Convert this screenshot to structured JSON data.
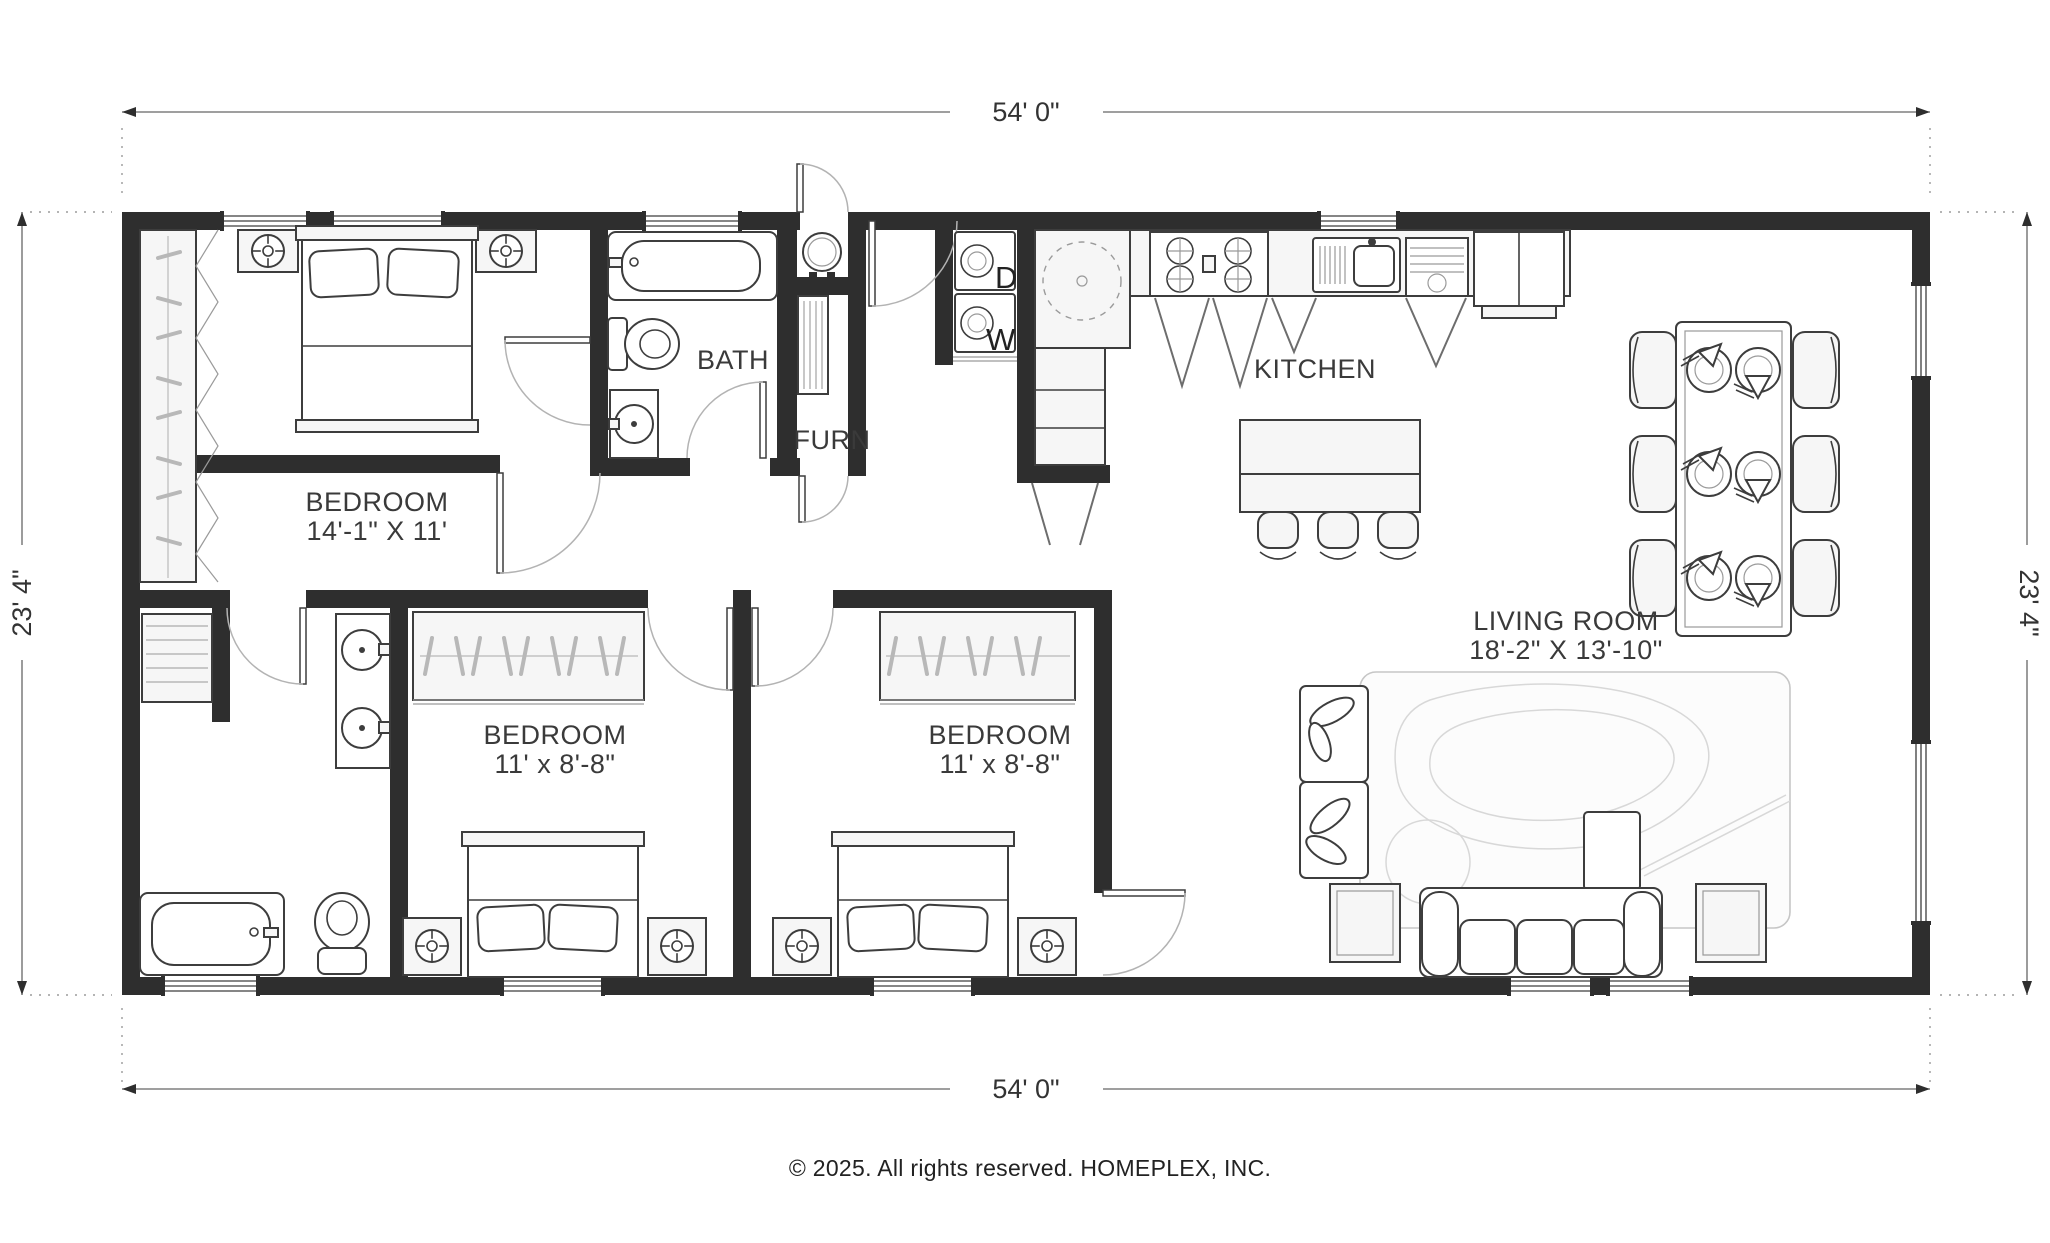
{
  "dimensions": {
    "top": "54' 0\"",
    "bottom": "54' 0\"",
    "left": "23' 4\"",
    "right": "23' 4\""
  },
  "rooms": {
    "bedroom1": {
      "name": "BEDROOM",
      "size": "14'-1\" X 11'"
    },
    "bath": {
      "name": "BATH"
    },
    "furnace": {
      "name": "FURN"
    },
    "kitchen": {
      "name": "KITCHEN"
    },
    "bedroom2": {
      "name": "BEDROOM",
      "size": "11' x 8'-8\""
    },
    "bedroom3": {
      "name": "BEDROOM",
      "size": "11' x 8'-8\""
    },
    "living": {
      "name": "LIVING ROOM",
      "size": "18'-2\" X 13'-10\""
    }
  },
  "appliances": {
    "dryer": "D",
    "washer": "W"
  },
  "footer": {
    "copyright": "© 2025. All rights reserved. HOMEPLEX, INC."
  },
  "colors": {
    "wall": "#2e2e2e",
    "line": "#3d3d3d",
    "paper": "#ffffff"
  }
}
